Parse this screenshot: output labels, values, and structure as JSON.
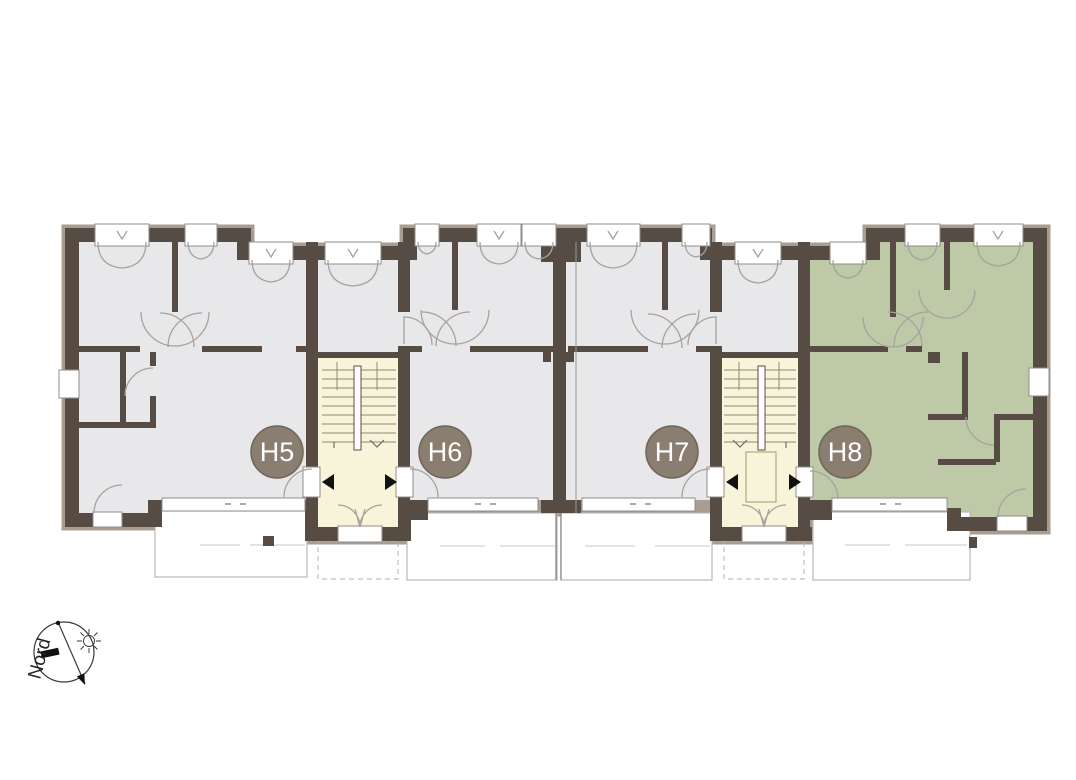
{
  "plan": {
    "units": [
      {
        "label": "H5"
      },
      {
        "label": "H6"
      },
      {
        "label": "H7"
      },
      {
        "label": "H8"
      }
    ],
    "colors": {
      "wall": "#574c43",
      "wall_edge": "#a89d90",
      "floor": "#e8e7e9",
      "unit_h8": "#bec9a7",
      "stairwell": "#f8f4da",
      "badge": "#8a7e71",
      "badge_text": "#ffffff"
    }
  },
  "compass": {
    "label": "Nord"
  }
}
